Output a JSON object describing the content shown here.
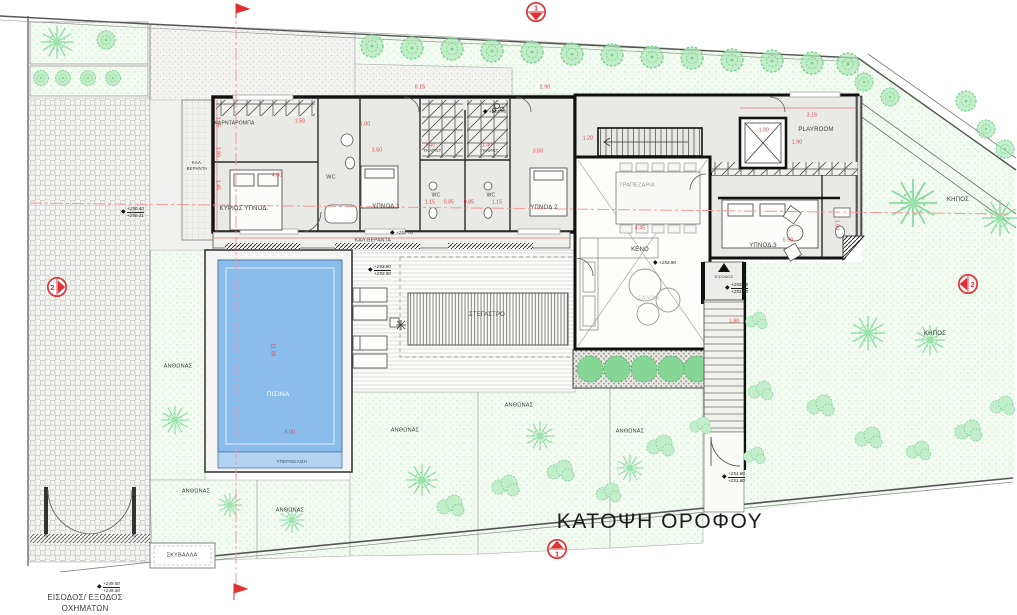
{
  "title": {
    "text": "ΚΑΤΟΨΗ ΟΡΟΦΟΥ"
  },
  "colors": {
    "wall": "#111111",
    "floor": "#e9e9e6",
    "pool_water": "#8abcec",
    "pool_overflow": "#b3d3f2",
    "garden_green": "#f2faf1",
    "tree_green": "#86dd9b",
    "dimension_red": "#e04545",
    "section_marker_red": "#e03030",
    "centerline_pink": "#f29b9b"
  },
  "room_labels": [
    {
      "name": "label-garderoba",
      "text": "ΓΚΑΡΝΤΑΡΟΜΠΑ",
      "x": 233,
      "y": 124,
      "s": 5
    },
    {
      "name": "label-master-bedroom",
      "text": "ΚΥΡΙΩΣ ΥΠΝΟΔ.",
      "x": 244,
      "y": 209,
      "s": 6
    },
    {
      "name": "label-kal-veranta-left-1",
      "text": "ΚΑΛ.",
      "x": 197,
      "y": 163,
      "s": 4.3
    },
    {
      "name": "label-kal-veranta-left-2",
      "text": "ΒΕΡΑΝΤΑ",
      "x": 197,
      "y": 169,
      "s": 4.3
    },
    {
      "name": "label-wc-main",
      "text": "WC",
      "x": 331,
      "y": 178,
      "s": 5.5
    },
    {
      "name": "label-bedroom-1",
      "text": "ΥΠΝΟΔ.1",
      "x": 386,
      "y": 207,
      "s": 6
    },
    {
      "name": "label-garnt-1",
      "text": "ΓΚΑΡΝΤ.",
      "x": 433,
      "y": 151,
      "s": 4.3
    },
    {
      "name": "label-garnt-2",
      "text": "ΓΚΑΡΝΤ.",
      "x": 490,
      "y": 151,
      "s": 4.3
    },
    {
      "name": "label-wc-1",
      "text": "WC",
      "x": 436,
      "y": 196,
      "s": 5
    },
    {
      "name": "label-wc-2",
      "text": "WC",
      "x": 491,
      "y": 196,
      "s": 5
    },
    {
      "name": "label-kal-veranta-bottom",
      "text": "ΚΑΛ.ΒΕΡΑΝΤΑ",
      "x": 373,
      "y": 241,
      "s": 5
    },
    {
      "name": "label-bedroom-2",
      "text": "ΥΠΝΟΔ.2",
      "x": 544,
      "y": 208,
      "s": 6
    },
    {
      "name": "label-trapezaria",
      "text": "ΤΡΑΠΕΖΑΡΙΑ",
      "x": 637,
      "y": 186,
      "s": 5.5,
      "c": "#9a9a9a"
    },
    {
      "name": "label-keno",
      "text": "ΚΕΝΟ",
      "x": 640,
      "y": 250,
      "s": 6
    },
    {
      "name": "label-saloni",
      "text": "ΣΑΛΟΝΙ",
      "x": 649,
      "y": 299,
      "s": 5.5,
      "c": "#bcbcbc"
    },
    {
      "name": "label-playroom",
      "text": "PLAYROOM",
      "x": 816,
      "y": 130,
      "s": 6
    },
    {
      "name": "label-bedroom-3",
      "text": "ΥΠΝΟΔ.3",
      "x": 763,
      "y": 246,
      "s": 6
    },
    {
      "name": "label-entrance-stair",
      "text": "ΕΙΣΟΔΟΣ",
      "x": 724,
      "y": 277,
      "s": 4
    }
  ],
  "site_labels": [
    {
      "name": "label-pool",
      "text": "ΠΙΣΙΝΑ",
      "x": 278,
      "y": 395,
      "s": 6.5,
      "c": "#ffffff"
    },
    {
      "name": "label-overflow",
      "text": "ΥΠΕΡΧΕΙΛΙΣΗ",
      "x": 292,
      "y": 462,
      "s": 4.3,
      "c": "#33506e"
    },
    {
      "name": "label-canopy",
      "text": "ΣΤΕΓΑΣΤΡΟ",
      "x": 487,
      "y": 315,
      "s": 6,
      "c": "#4a4a4a"
    },
    {
      "name": "label-flowerbed-1",
      "text": "ΑΝΘΩΝΑΣ",
      "x": 178,
      "y": 367,
      "s": 5.5
    },
    {
      "name": "label-flowerbed-2",
      "text": "ΑΝΘΩΝΑΣ",
      "x": 196,
      "y": 492,
      "s": 5.5
    },
    {
      "name": "label-flowerbed-3",
      "text": "ΑΝΘΩΝΑΣ",
      "x": 290,
      "y": 511,
      "s": 5.5
    },
    {
      "name": "label-flowerbed-4",
      "text": "ΑΝΘΩΝΑΣ",
      "x": 405,
      "y": 431,
      "s": 5.5
    },
    {
      "name": "label-flowerbed-5",
      "text": "ΑΝΘΩΝΑΣ",
      "x": 519,
      "y": 406,
      "s": 5.5
    },
    {
      "name": "label-flowerbed-6",
      "text": "ΑΝΘΩΝΑΣ",
      "x": 630,
      "y": 432,
      "s": 5.5
    },
    {
      "name": "label-garden-1",
      "text": "ΚΗΠΟΣ",
      "x": 958,
      "y": 200,
      "s": 6
    },
    {
      "name": "label-garden-2",
      "text": "ΚΗΠΟΣ",
      "x": 935,
      "y": 334,
      "s": 6
    },
    {
      "name": "label-garbage",
      "text": "ΣΚΥΒΑΛΛΑ",
      "x": 182,
      "y": 556,
      "s": 5.5
    },
    {
      "name": "label-vehicle-entry-1",
      "text": "ΕΙΣΟΔΟΣ/ ΕΞΟΔΟΣ",
      "x": 85,
      "y": 598,
      "s": 8
    },
    {
      "name": "label-vehicle-entry-2",
      "text": "ΟΧΗΜΑΤΩΝ",
      "x": 85,
      "y": 609,
      "s": 8
    }
  ],
  "dim_labels": [
    {
      "text": "1.45",
      "x": 217,
      "y": 122,
      "r": 90
    },
    {
      "text": "1.80",
      "x": 217,
      "y": 152,
      "r": 90
    },
    {
      "text": "1.45",
      "x": 217,
      "y": 185,
      "r": 90
    },
    {
      "text": "1.50",
      "x": 300,
      "y": 122,
      "r": 0
    },
    {
      "text": "1.00",
      "x": 365,
      "y": 125,
      "r": 0
    },
    {
      "text": "4.00",
      "x": 277,
      "y": 176,
      "r": 0
    },
    {
      "text": "3.50",
      "x": 377,
      "y": 151,
      "r": 0
    },
    {
      "text": "3.50",
      "x": 538,
      "y": 152,
      "r": 0
    },
    {
      "text": "1.40",
      "x": 430,
      "y": 146,
      "r": 0
    },
    {
      "text": "1.40",
      "x": 487,
      "y": 146,
      "r": 0
    },
    {
      "text": "1.15",
      "x": 430,
      "y": 203,
      "r": 0
    },
    {
      "text": "0.85",
      "x": 449,
      "y": 203,
      "r": 0
    },
    {
      "text": "0.85",
      "x": 469,
      "y": 203,
      "r": 0
    },
    {
      "text": "1.15",
      "x": 497,
      "y": 203,
      "r": 0
    },
    {
      "text": "1.20",
      "x": 588,
      "y": 139,
      "r": 0
    },
    {
      "text": "1.90",
      "x": 797,
      "y": 143,
      "r": 0
    },
    {
      "text": "1.80",
      "x": 764,
      "y": 131,
      "r": 0
    },
    {
      "text": "3.15",
      "x": 812,
      "y": 116,
      "r": 0
    },
    {
      "text": "4.45",
      "x": 640,
      "y": 229,
      "r": 0
    },
    {
      "text": "5.50",
      "x": 788,
      "y": 241,
      "r": 0
    },
    {
      "text": "1.50",
      "x": 836,
      "y": 225,
      "r": 90
    },
    {
      "text": "11.00",
      "x": 272,
      "y": 350,
      "r": 90
    },
    {
      "text": "6.00",
      "x": 290,
      "y": 433,
      "r": 0
    },
    {
      "text": "1.80",
      "x": 734,
      "y": 322,
      "r": 0
    },
    {
      "text": "2.90",
      "x": 545,
      "y": 88,
      "r": 0
    },
    {
      "text": "0.15",
      "x": 420,
      "y": 88,
      "r": 0
    }
  ],
  "elevations": [
    {
      "v1": "+250.40",
      "v2": "+250.31",
      "x": 121,
      "y": 212
    },
    {
      "v1": "+257.75",
      "v2": "",
      "x": 483,
      "y": 112
    },
    {
      "v1": "+257.70",
      "v2": "",
      "x": 390,
      "y": 233
    },
    {
      "v1": "+253.90",
      "v2": "+253.50",
      "x": 368,
      "y": 270
    },
    {
      "v1": "+253.90",
      "v2": "",
      "x": 653,
      "y": 263
    },
    {
      "v1": "+253.85",
      "v2": "+253.50",
      "x": 725,
      "y": 288
    },
    {
      "v1": "+251.80",
      "v2": "+251.80",
      "x": 722,
      "y": 477
    },
    {
      "v1": "+249.50",
      "v2": "+249.30",
      "x": 97,
      "y": 587
    }
  ],
  "section_markers": {
    "top": {
      "label": "1"
    },
    "bottom": {
      "label": "1"
    },
    "left": {
      "label": "2"
    },
    "right": {
      "label": "2"
    }
  }
}
